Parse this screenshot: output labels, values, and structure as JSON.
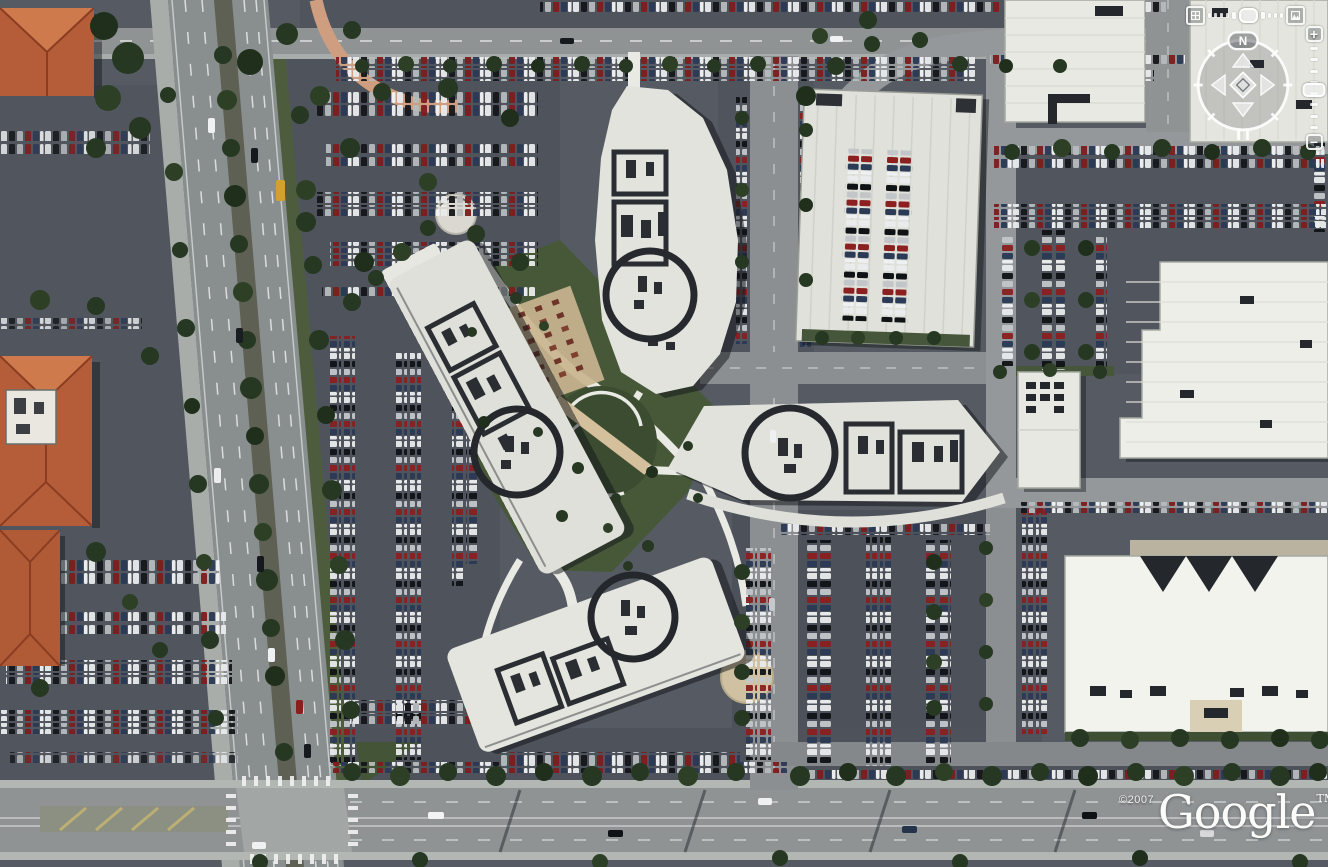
{
  "app": {
    "title": "Satellite aerial view"
  },
  "watermark": {
    "copyright": "©2007",
    "logo": "Google",
    "trademark": "TM"
  },
  "nav": {
    "north_label": "N",
    "zoom_in_label": "+",
    "zoom_out_label": "−"
  },
  "icons": [
    "top-down-view-icon",
    "horizon-view-icon",
    "tilt-slider-handle",
    "compass-ring",
    "north-indicator",
    "pan-up-arrow",
    "pan-down-arrow",
    "pan-left-arrow",
    "pan-right-arrow",
    "center-knob",
    "zoom-in-icon",
    "zoom-out-icon",
    "zoom-slider-handle",
    "google-logo-watermark"
  ],
  "colors": {
    "asphalt": "#565b63",
    "parking_lot": "#4f545c",
    "road": "#8f9394",
    "concrete": "#aaaeac",
    "roof_white": "#e8e9e2",
    "roof_bright": "#f2f3ed",
    "roof_tile_orange": "#b55d38",
    "grass": "#475839",
    "tree": "#263722",
    "path_tan": "#d3bf9c",
    "path_pink": "#cf9e80",
    "control_white": "#ffffff",
    "watermark_white": "#fbfcfa"
  },
  "scene": {
    "type": "satellite imagery, top-down",
    "features": [
      "four curved white office buildings arranged around a central courtyard",
      "dark circular ring markings on each building rooftop",
      "parking structure with rooftop parking rows (top right of campus)",
      "dense surface parking lots filled with parked cars",
      "multi-lane divided arterial road with tree-lined median (left)",
      "tree-lined boulevard with signalized intersection (bottom)",
      "terracotta tile-roofed buildings along left edge",
      "white flat-roof industrial buildings on right and top-right",
      "amphitheater lawn with concentric paths in the courtyard",
      "outdoor patio with rows of tables beside west building"
    ]
  }
}
